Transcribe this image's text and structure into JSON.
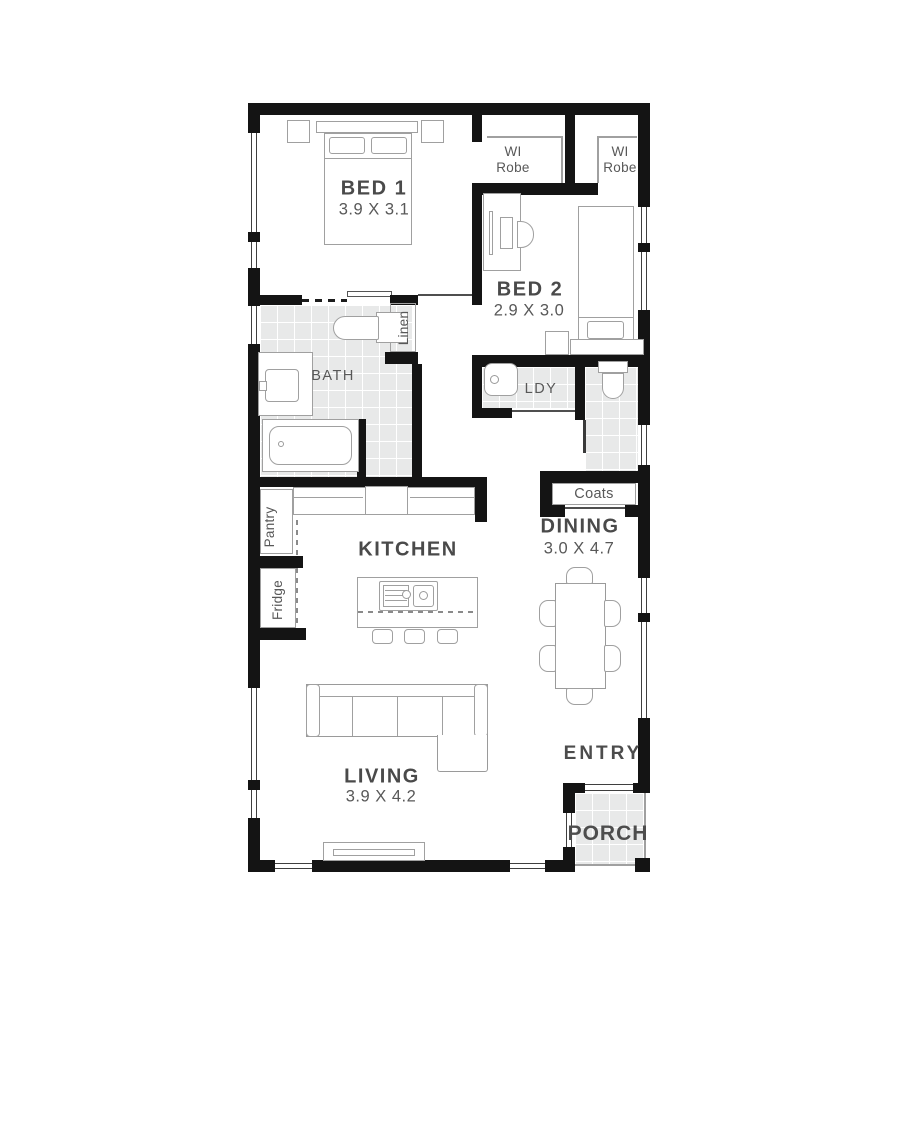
{
  "plan": {
    "rooms": {
      "bed1": {
        "name": "BED 1",
        "dims": "3.9 X 3.1"
      },
      "bed2": {
        "name": "BED 2",
        "dims": "2.9 X 3.0"
      },
      "bath": {
        "name": "BATH"
      },
      "laundry": {
        "name": "LDY"
      },
      "kitchen": {
        "name": "KITCHEN"
      },
      "dining": {
        "name": "DINING",
        "dims": "3.0 X 4.7"
      },
      "living": {
        "name": "LIVING",
        "dims": "3.9 X 4.2"
      },
      "entry": {
        "name": "ENTRY"
      },
      "porch": {
        "name": "PORCH"
      }
    },
    "storage": {
      "wirobe1": {
        "line1": "WI",
        "line2": "Robe"
      },
      "wirobe2": {
        "line1": "WI",
        "line2": "Robe"
      },
      "linen": "Linen",
      "coats": "Coats",
      "pantry": "Pantry",
      "fridge": "Fridge"
    },
    "colors": {
      "wall": "#141414",
      "tile_floor": "#e8e9e9",
      "furniture_outline": "#9a9a9a",
      "label_text": "#4a4a4a"
    }
  }
}
